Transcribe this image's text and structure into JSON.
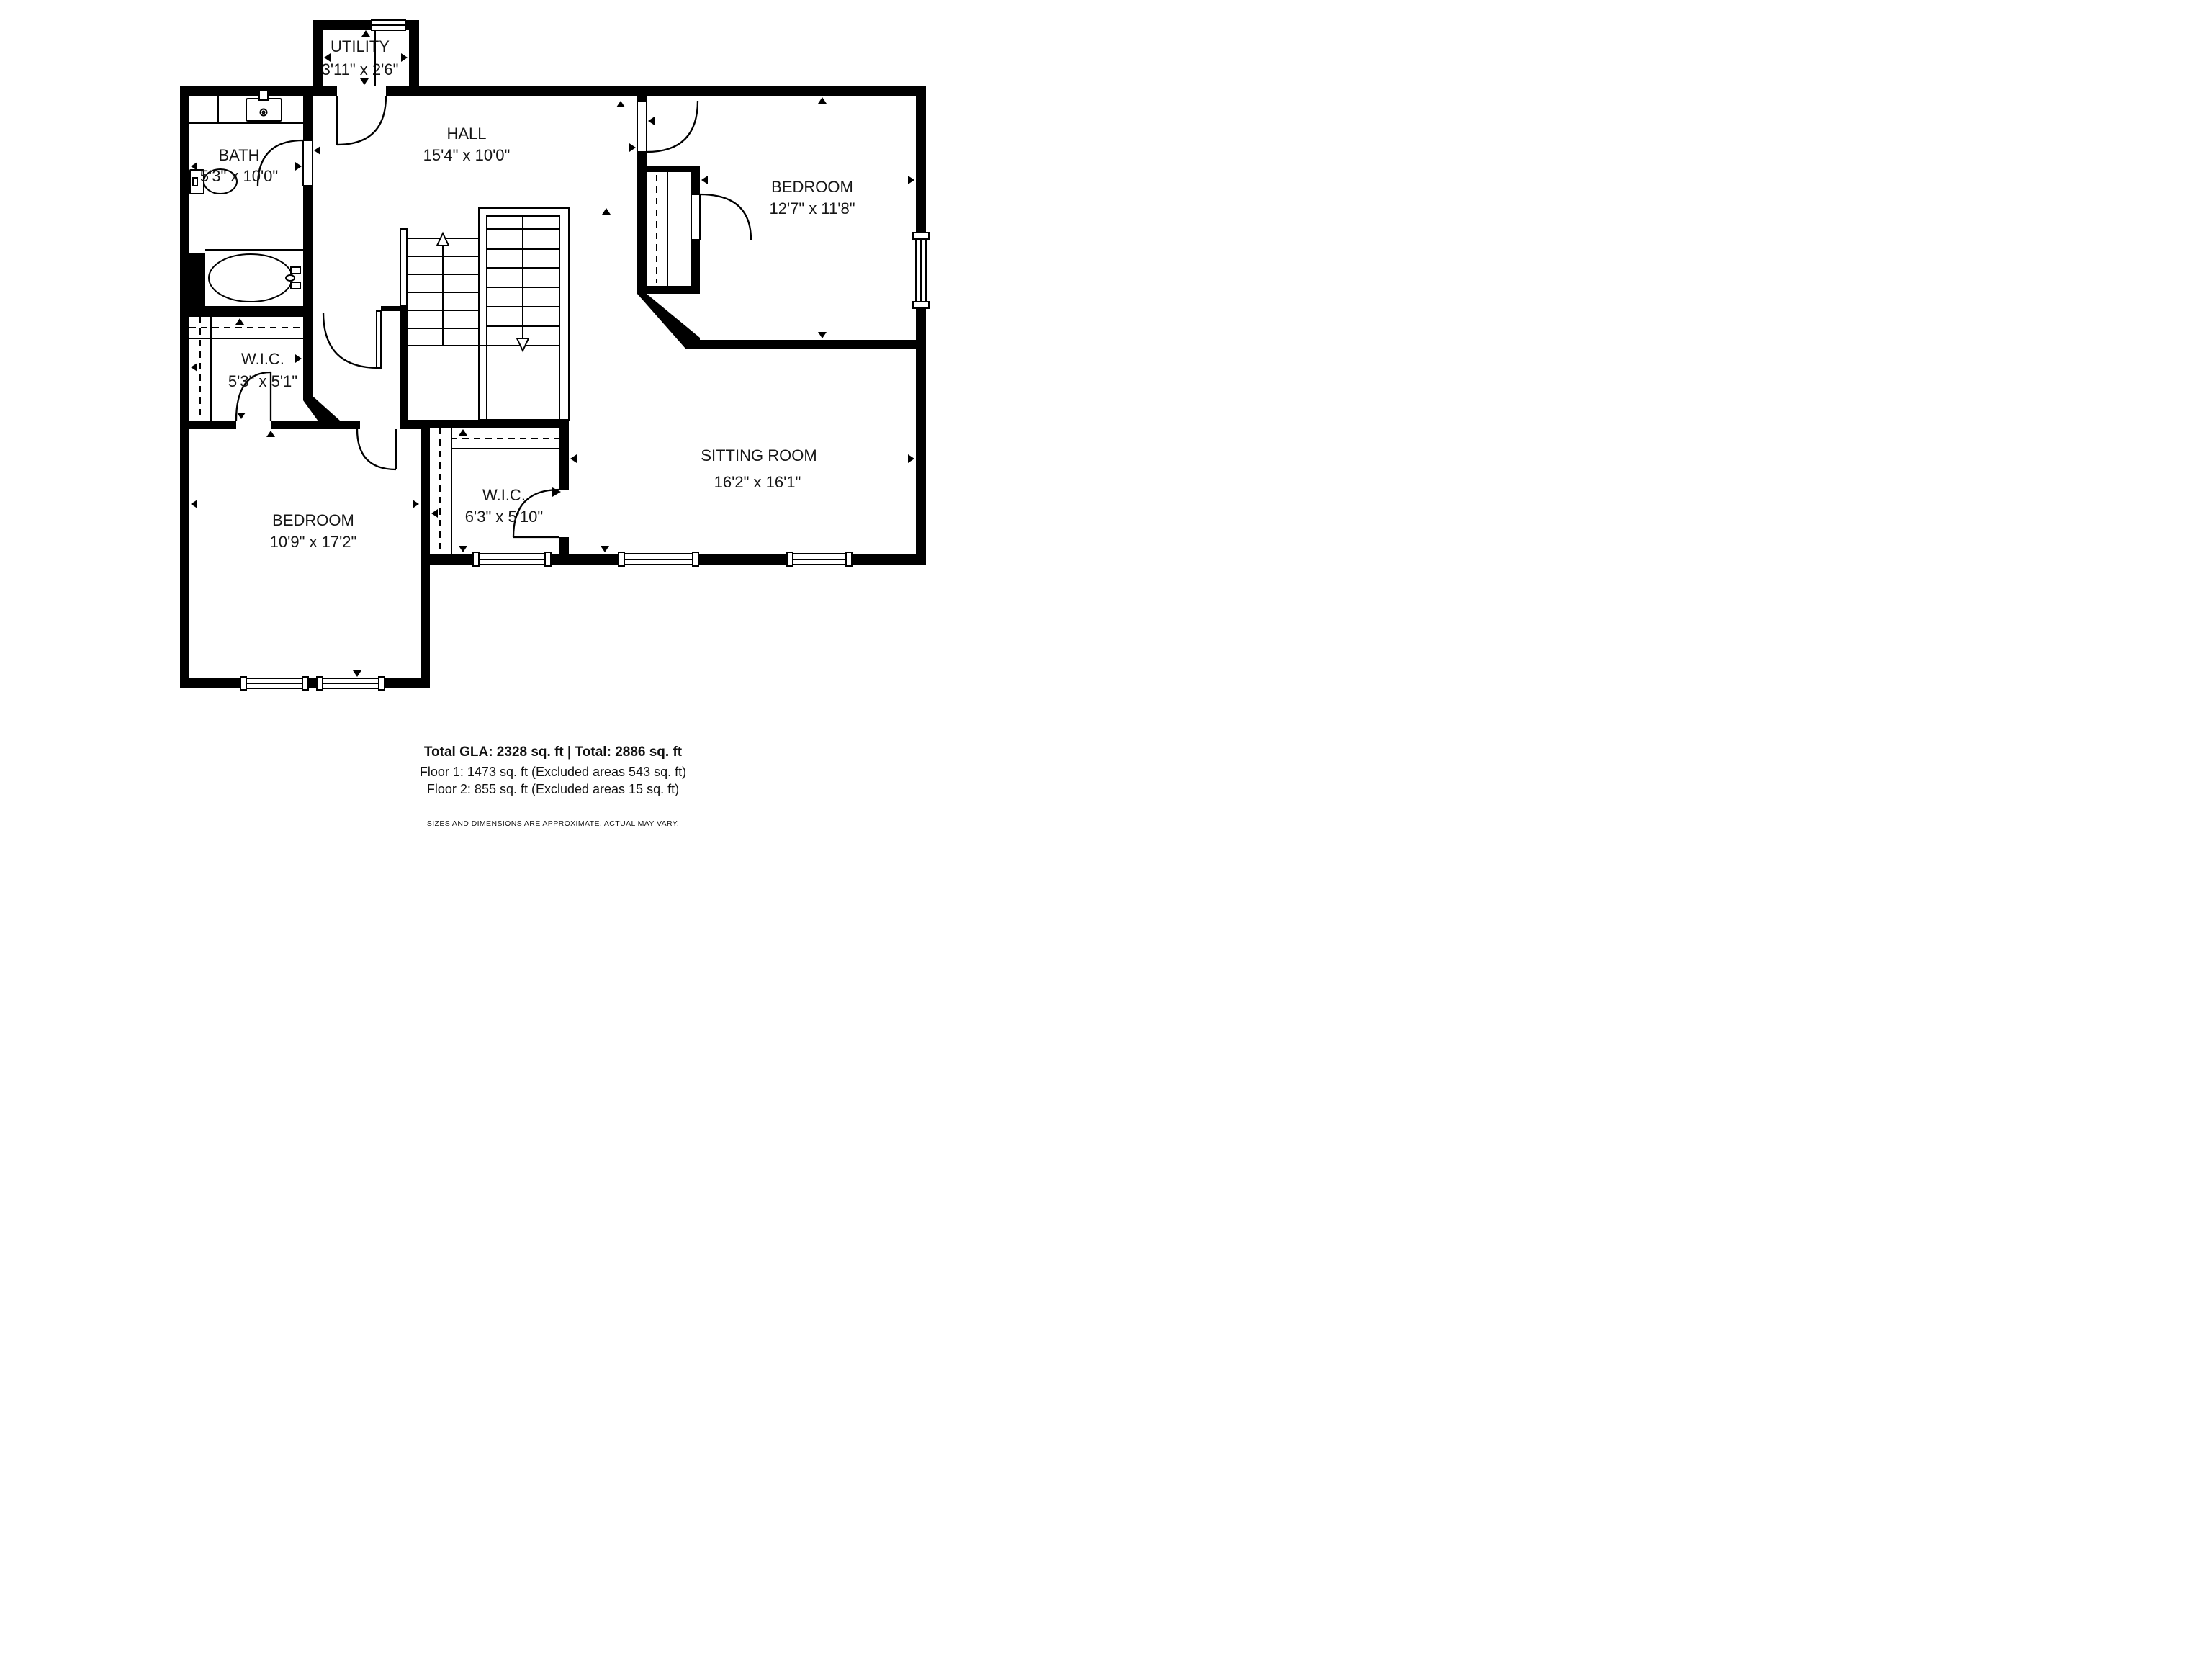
{
  "plan": {
    "rooms": {
      "utility": {
        "name": "UTILITY",
        "dims": "3'11\" x 2'6\""
      },
      "hall": {
        "name": "HALL",
        "dims": "15'4\" x 10'0\""
      },
      "bath": {
        "name": "BATH",
        "dims": "5'3\" x 10'0\""
      },
      "bedroom_top": {
        "name": "BEDROOM",
        "dims": "12'7\" x 11'8\""
      },
      "wic_left": {
        "name": "W.I.C.",
        "dims": "5'3\" x 5'1\""
      },
      "sitting_room": {
        "name": "SITTING ROOM",
        "dims": "16'2\" x 16'1\""
      },
      "bedroom_left": {
        "name": "BEDROOM",
        "dims": "10'9\" x 17'2\""
      },
      "wic_mid": {
        "name": "W.I.C.",
        "dims": "6'3\" x 5'10\""
      }
    },
    "footer": {
      "totals": "Total GLA: 2328 sq. ft | Total: 2886 sq. ft",
      "floor1": "Floor 1: 1473 sq. ft (Excluded areas 543 sq. ft)",
      "floor2": "Floor 2: 855 sq. ft (Excluded areas 15 sq. ft)",
      "disclaimer": "SIZES AND DIMENSIONS ARE APPROXIMATE, ACTUAL MAY VARY."
    },
    "colors": {
      "wall": "#000000",
      "background": "#ffffff",
      "text": "#161616"
    }
  }
}
